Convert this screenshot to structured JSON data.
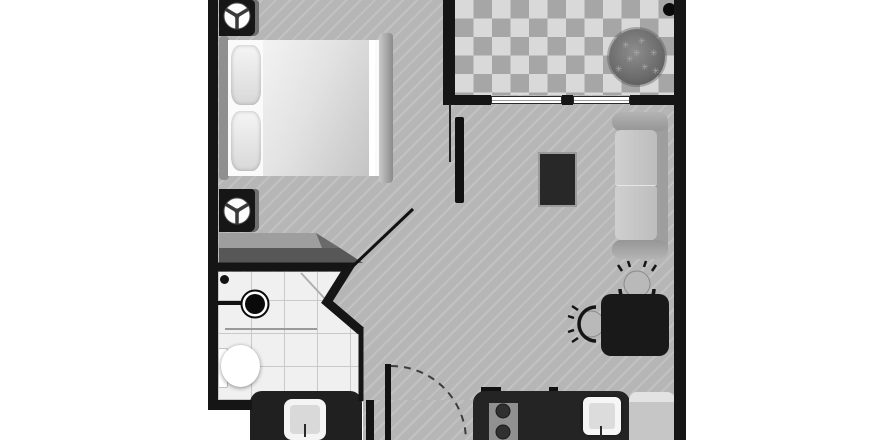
{
  "title": "Studio apartment floor plan",
  "palette": {
    "background": "#ffffff",
    "wall": "#151515",
    "floor_gray": "#b6b6b6",
    "balcony_tile_light": "#d9d9d9",
    "balcony_tile_dark": "#a6a6a6",
    "bathroom_tile": "#f0f0f0",
    "furniture_dark": "#202020",
    "furniture_light": "#c9c9c9"
  },
  "rooms": {
    "bedroom": {
      "label": "Bedroom"
    },
    "living": {
      "label": "Living room"
    },
    "bathroom": {
      "label": "Bathroom"
    },
    "balcony": {
      "label": "Balcony with checkered tile and plant"
    },
    "kitchen": {
      "label": "Kitchen area"
    }
  },
  "furniture": {
    "bed": {
      "label": "Double bed with two pillows"
    },
    "nightstand_top": {
      "label": "Nightstand with fan symbol"
    },
    "nightstand_bottom": {
      "label": "Nightstand with fan symbol"
    },
    "wardrobe": {
      "label": "Wardrobe / closet wedge"
    },
    "tv": {
      "label": "TV / low table"
    },
    "sofa": {
      "label": "Two-seat sofa"
    },
    "dining_table": {
      "label": "Dining table"
    },
    "chairs": {
      "label": "Two chairs",
      "count": 2
    },
    "plant": {
      "label": "Potted plant"
    },
    "counter": {
      "label": "Kitchen counter"
    },
    "stove": {
      "label": "Stove with burners",
      "visible_burners": 2
    },
    "kitchen_sink": {
      "label": "Kitchen sink"
    },
    "fridge": {
      "label": "Refrigerator"
    },
    "washer": {
      "label": "Washing machine"
    },
    "toilet": {
      "label": "Toilet"
    },
    "bath_sink": {
      "label": "Round basin"
    },
    "entry_door": {
      "label": "Entry door with swing arc"
    },
    "bedroom_door": {
      "label": "Open interior door"
    }
  }
}
